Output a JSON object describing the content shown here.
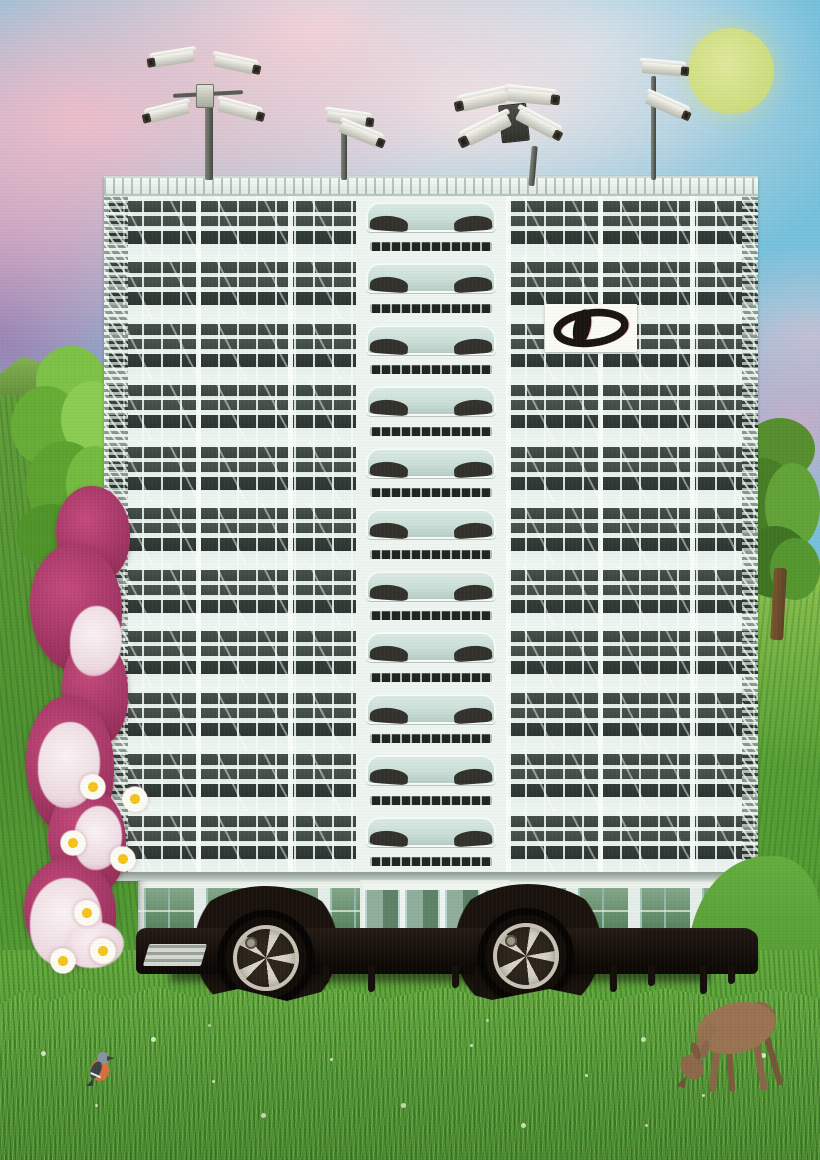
{
  "artwork": {
    "type": "surreal photo collage",
    "description": "A tall modular apartment block mounted on a black car chassis with alloy wheels, parked in a grassy meadow; CCTV camera masts on the roof, a yellow-green moon in a pink-and-blue cloudy sky, a magenta flower garland down the left facade, a grazing deer and a small bird in the grass.",
    "visible_text": "none"
  },
  "palette": {
    "sky_blue": "#76c1dc",
    "cloud_pink": "#f0bec9",
    "sky_purple": "#987ab0",
    "moon_yellow": "#d2df77",
    "facade_mint": "#eaf3ee",
    "window_dark": "#2c3531",
    "glass_green": "#57855f",
    "grass_green": "#58a438",
    "grass_dark": "#3f7d2c",
    "flower_magenta": "#a03462",
    "flower_white": "#f3e8ec",
    "daisy_yellow": "#f4c31d",
    "car_black": "#130d08",
    "rim_silver": "#d9d4c7",
    "deer_brown": "#9a7351",
    "bird_orange": "#d96f3e",
    "logo_black": "#1a1412",
    "logo_background": "#fbfbf5"
  },
  "sky": {
    "moon": {
      "visible": true,
      "color": "#d2df77",
      "position": "top-right"
    },
    "clouds": "pink and white cumulus over blue"
  },
  "building": {
    "floor_count": 11,
    "bay_style": "each floor's center bay is a collaged white car windshield",
    "eye_logo": {
      "shape": "black oval outline with slanted black lens",
      "background": "white rectangle",
      "floor": 3,
      "side": "right of center"
    },
    "ground_floor": "glass storefront reflecting green trees, central entrance doors",
    "roof": "white parapet railing"
  },
  "surveillance": {
    "camera_cluster_count": 4,
    "total_cameras": 12,
    "style": "white bullet CCTV cameras on grey poles"
  },
  "vehicle": {
    "type": "black car chassis under building",
    "visible_wheels": 2,
    "wheel_style": "five-spoke silver alloy rims",
    "details": [
      "dark wheel arches",
      "paint drips under sills",
      "small boarding step at left"
    ]
  },
  "nature": {
    "left_hill": true,
    "left_tree": "bright green deciduous tree",
    "right_tree": "darker green tree with visible trunk",
    "flower_garland": {
      "daisy_count": 7,
      "colors": [
        "magenta",
        "white"
      ],
      "position": "left edge of building"
    },
    "deer": {
      "pose": "grazing head-down",
      "position": "bottom right"
    },
    "bird": {
      "species_look": "chaffinch with orange breast and grey head",
      "position": "bottom left grass"
    },
    "grass": "tall meadow with white seed heads"
  }
}
